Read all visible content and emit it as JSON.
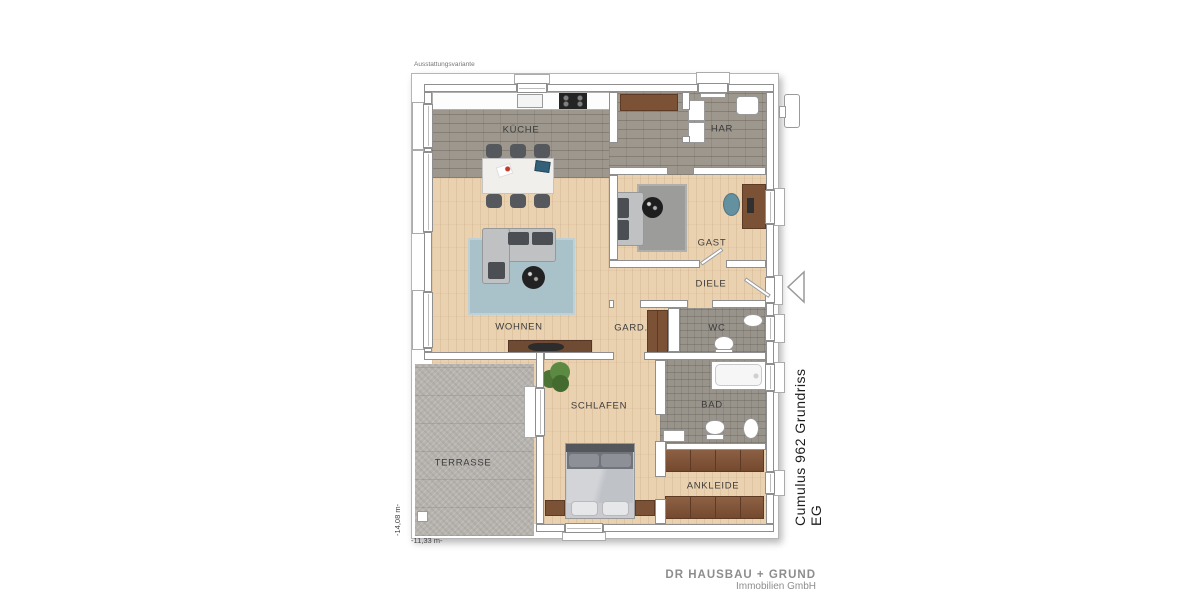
{
  "page": {
    "variant_label": "Ausstattungsvariante",
    "plan_title": "Cumulus 962 Grundriss EG",
    "company": {
      "line1": "DR HAUSBAU + GRUND",
      "line2": "Immobilien GmbH"
    },
    "dimensions": {
      "width_label": "-11,33 m-",
      "height_label": "-14,08 m-"
    }
  },
  "rooms": {
    "kueche": {
      "label": "KÜCHE"
    },
    "har": {
      "label": "HAR"
    },
    "gast": {
      "label": "GAST"
    },
    "diele": {
      "label": "DIELE"
    },
    "wohnen": {
      "label": "WOHNEN"
    },
    "gard": {
      "label": "GARD."
    },
    "wc": {
      "label": "WC"
    },
    "schlafen": {
      "label": "SCHLAFEN"
    },
    "bad": {
      "label": "BAD"
    },
    "ankleide": {
      "label": "ANKLEIDE"
    },
    "terrasse": {
      "label": "TERRASSE"
    }
  },
  "colors": {
    "wood_floor": "#ead1af",
    "tile_grey": "#9d978d",
    "bath_tile": "#99948b",
    "terrace_stone": "#b7b4af",
    "rug_blue": "#a9c2ca",
    "rug_grey": "#9c9c9a",
    "furniture_wood": "#7b5236",
    "sofa_grey": "#bfc1c3",
    "cushion_dark": "#4b4f54",
    "wall_outline": "#8f8f8f",
    "label_text": "#3b3b3b",
    "company_text": "#8d8d8d"
  }
}
